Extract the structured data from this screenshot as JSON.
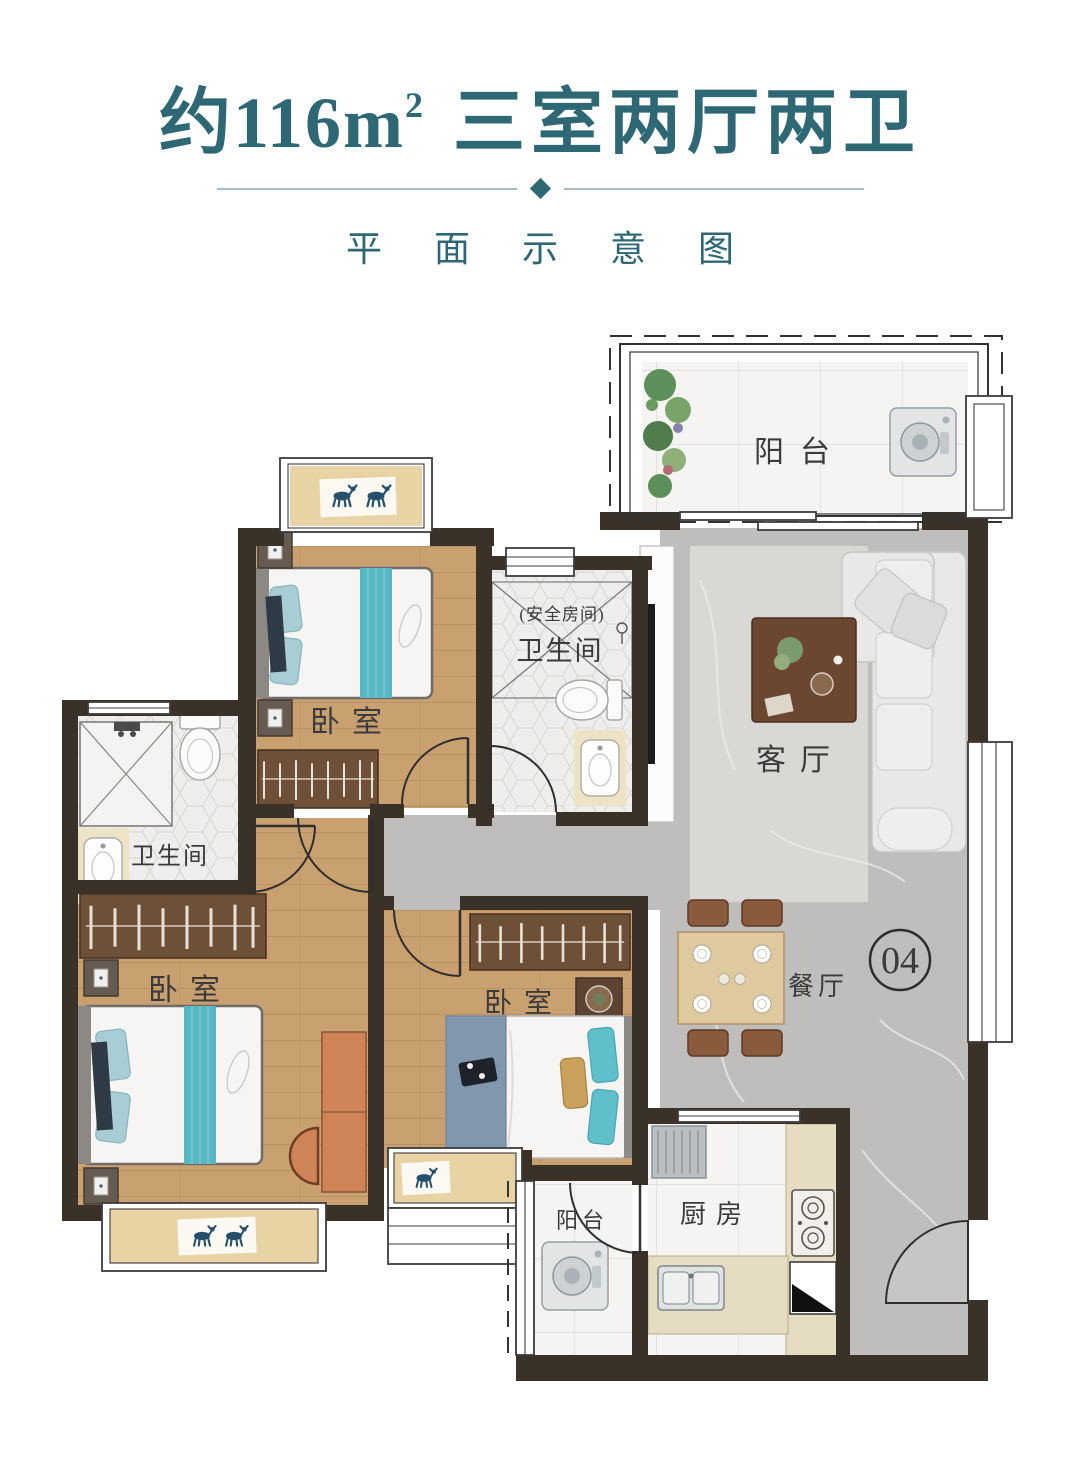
{
  "header": {
    "title_area": "约116m",
    "title_sup": "2",
    "title_rooms": "三室两厅两卫",
    "subtitle": "平面示意图"
  },
  "plan": {
    "labels": {
      "balcony_top": "阳台",
      "bedroom_top": "卧室",
      "bath_center_note": "(安全房间)",
      "bath_center": "卫生间",
      "bath_left": "卫生间",
      "living": "客厅",
      "bedroom_left": "卧室",
      "bedroom_mid": "卧室",
      "dining": "餐厅",
      "unit_number": "04",
      "kitchen": "厨房",
      "balcony_bottom": "阳台"
    },
    "colors": {
      "accent": "#2f6875",
      "dividerLine": "#a7bcc1",
      "wall": "#3a3129",
      "wood": "#c9a171",
      "woodLight": "#e8d3a4",
      "marble": "#bfbebc",
      "marbleLight": "#d9d8d5",
      "tile": "#f5f4f2",
      "hex": "#efeeec",
      "teal": "#57b7c3",
      "counter": "#e6dcc1",
      "labelText": "#3b3b3b"
    }
  }
}
